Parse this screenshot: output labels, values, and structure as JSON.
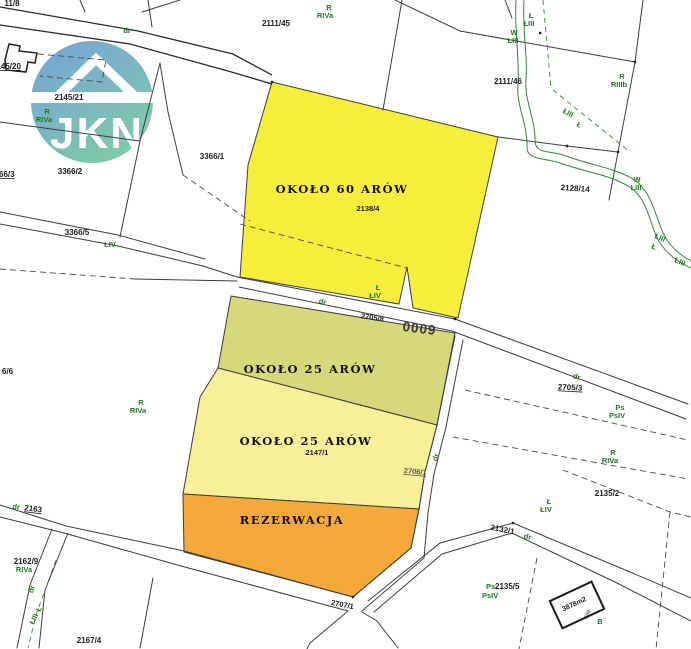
{
  "watermark": {
    "text": "JKN"
  },
  "highlight_parcels": [
    {
      "id": "parcel-60-arow",
      "label": "OKOŁO 60 ARÓW",
      "number": "2138/4",
      "color": "#f7ee3c"
    },
    {
      "id": "parcel-25-arow-upper",
      "label": "OKOŁO 25 ARÓW",
      "color": "#d7d77c"
    },
    {
      "id": "parcel-25-arow-lower",
      "label": "OKOŁO 25 ARÓW",
      "number": "2147/1",
      "color": "#f8f099"
    },
    {
      "id": "parcel-rezerwacja",
      "label": "REZERWACJA",
      "color": "#f4a93a"
    }
  ],
  "parcel_numbers": {
    "p11_8": "11/8",
    "p2145_20": "2145/20",
    "p2145_21": "2145/21",
    "p2111_45": "2111/45",
    "p2111_46": "2111/46",
    "p3366_1": "3366/1",
    "p3366_2": "3366/2",
    "p3366_3": "66/3",
    "p3366_5": "3366/5",
    "p2138_4": "2138/4",
    "p2128_14": "2128/14",
    "p2705_8": "2705/8",
    "p2705_3": "2705/3",
    "p0009": "0009",
    "p66_6": "6/6",
    "p2147_1": "2147/1",
    "p2706_1": "2706/1",
    "p2135_2": "2135/2",
    "p2132_1": "2132/1",
    "p2162_9": "2162/9",
    "p2163": "2163",
    "p2135_5": "2135/5",
    "p2707_1": "2707/1",
    "p2167_4": "2167/4",
    "building_area": "3878m2",
    "building_no": "689"
  },
  "land_use": {
    "dr": "dr",
    "r": "R",
    "riva": "RIVa",
    "riiib": "RIIIb",
    "l": "Ł",
    "liii": "ŁIII",
    "liv": "ŁIV",
    "w": "W",
    "ps": "Ps",
    "psiv": "PsIV",
    "b": "B"
  },
  "colors": {
    "parcel_60": "#f7ee3c",
    "parcel_25_upper": "#d7d77c",
    "parcel_25_lower": "#f8f099",
    "rezerwacja": "#f4a93a",
    "land_use_green": "#1e7a1e",
    "boundary": "#3d3d3d",
    "stream_green": "#2e8b2e",
    "logo_blue": "#6d9ed6",
    "logo_green": "#79c9a2"
  }
}
